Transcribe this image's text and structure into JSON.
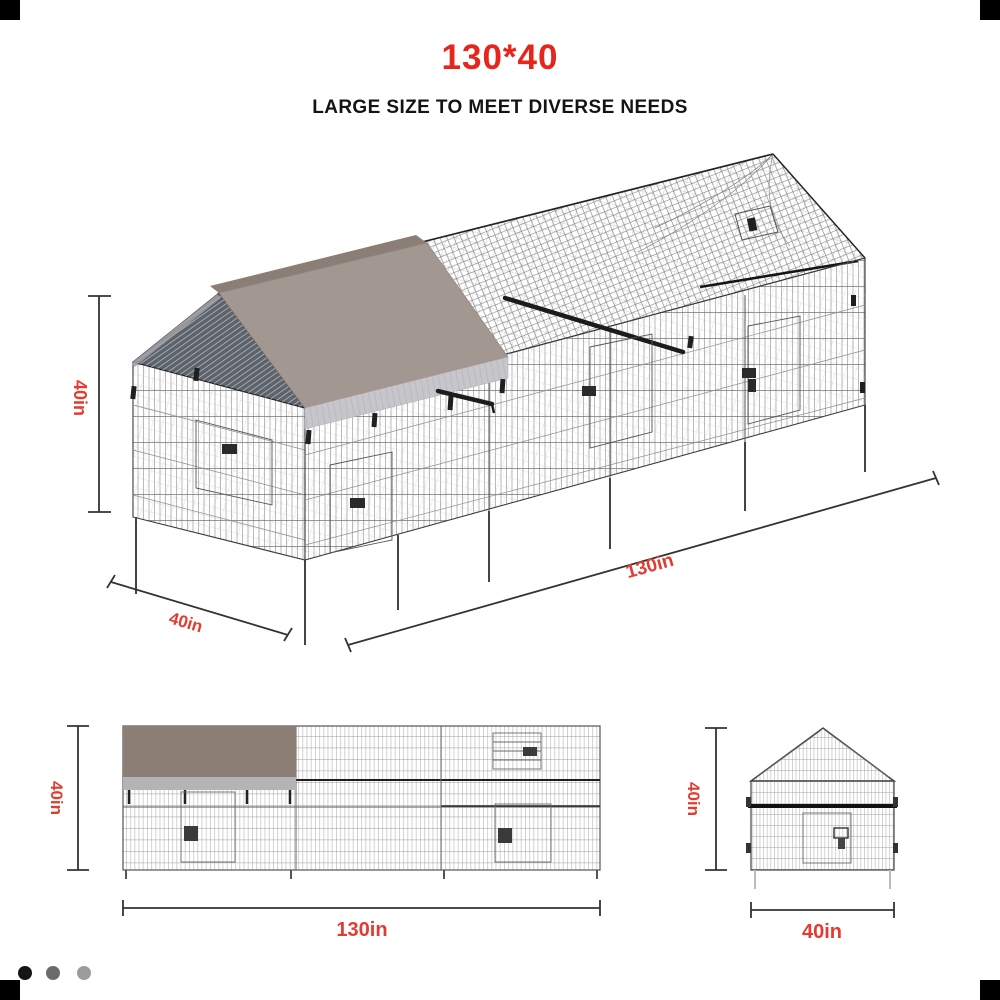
{
  "header": {
    "title": "130*40",
    "subtitle": "LARGE SIZE TO MEET DIVERSE NEEDS"
  },
  "perspective_view": {
    "height_label": "40in",
    "depth_label": "40in",
    "length_label": "130in"
  },
  "front_view": {
    "height_label": "40in",
    "width_label": "130in"
  },
  "end_view": {
    "height_label": "40in",
    "width_label": "40in"
  },
  "colors": {
    "accent_red": "#e6261b",
    "dimension_red": "#e23b30",
    "cover_taupe": "#a39792",
    "cover_skirt": "#c7c6cb",
    "side_cover": "#8b7e74",
    "side_skirt": "#b5b3b5",
    "gable_dark": "#5d636b"
  },
  "carousel": {
    "dots": [
      {
        "state": "active",
        "color": "#151515"
      },
      {
        "state": "inactive",
        "color": "#6b6b6b"
      },
      {
        "state": "inactive",
        "color": "#9c9c9c"
      }
    ]
  }
}
